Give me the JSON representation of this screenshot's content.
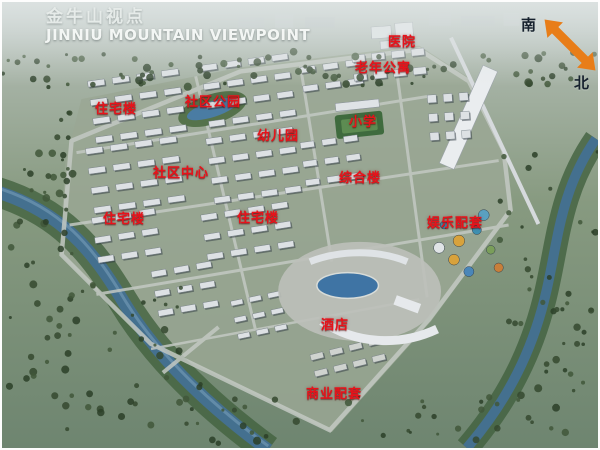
{
  "title": {
    "chinese": "金牛山视点",
    "english": "JINNIU MOUNTAIN VIEWPOINT"
  },
  "compass": {
    "south": "南",
    "north": "北"
  },
  "labels": [
    {
      "text": "医院",
      "x": 386,
      "y": 29
    },
    {
      "text": "老年公寓",
      "x": 353,
      "y": 55
    },
    {
      "text": "社区公园",
      "x": 183,
      "y": 89
    },
    {
      "text": "住宅楼",
      "x": 93,
      "y": 96
    },
    {
      "text": "小学",
      "x": 347,
      "y": 109
    },
    {
      "text": "幼儿园",
      "x": 255,
      "y": 123
    },
    {
      "text": "社区中心",
      "x": 151,
      "y": 160
    },
    {
      "text": "综合楼",
      "x": 337,
      "y": 165
    },
    {
      "text": "住宅楼",
      "x": 101,
      "y": 206
    },
    {
      "text": "住宅楼",
      "x": 235,
      "y": 205
    },
    {
      "text": "娱乐配套",
      "x": 425,
      "y": 210
    },
    {
      "text": "酒店",
      "x": 319,
      "y": 312
    },
    {
      "text": "商业配套",
      "x": 304,
      "y": 381
    }
  ],
  "colors": {
    "label_red": "#e8121a",
    "arrow_orange": "#e87d18",
    "title_white": "#f3f6f4",
    "water_blue": "#44708f"
  }
}
